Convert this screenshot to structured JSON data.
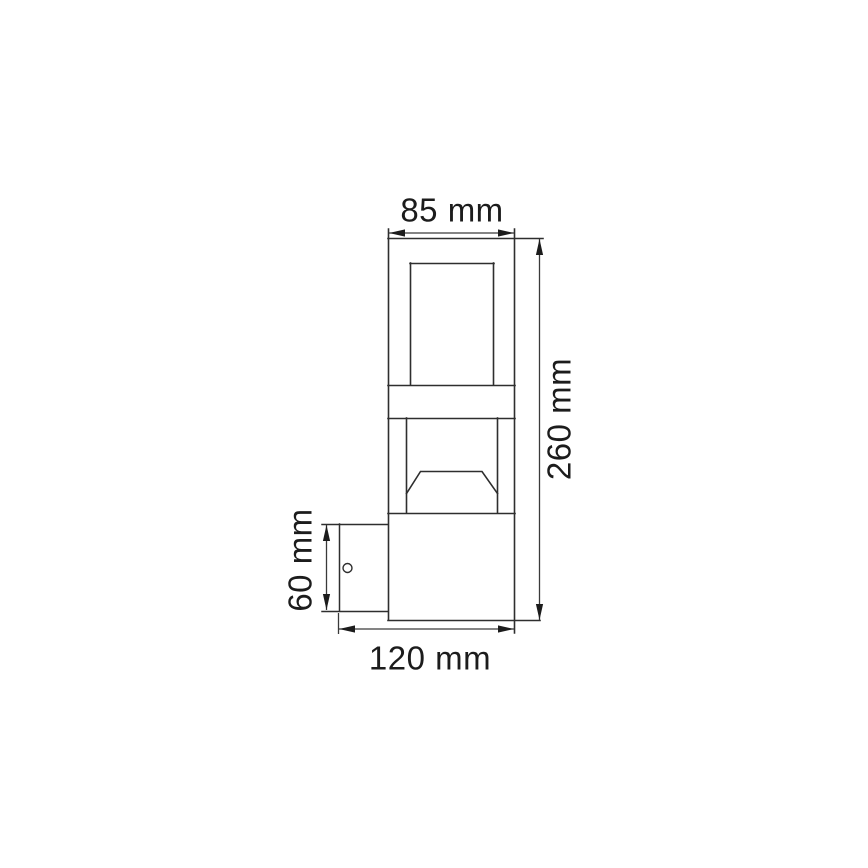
{
  "drawing": {
    "labels": {
      "top_width": "85 mm",
      "overall_height": "260 mm",
      "bracket_height": "60 mm",
      "overall_depth": "120 mm"
    },
    "colors": {
      "line": "#2e2e2e",
      "dimension_line": "#3a3a3a",
      "text": "#1c1c1c",
      "background": "#ffffff"
    }
  }
}
